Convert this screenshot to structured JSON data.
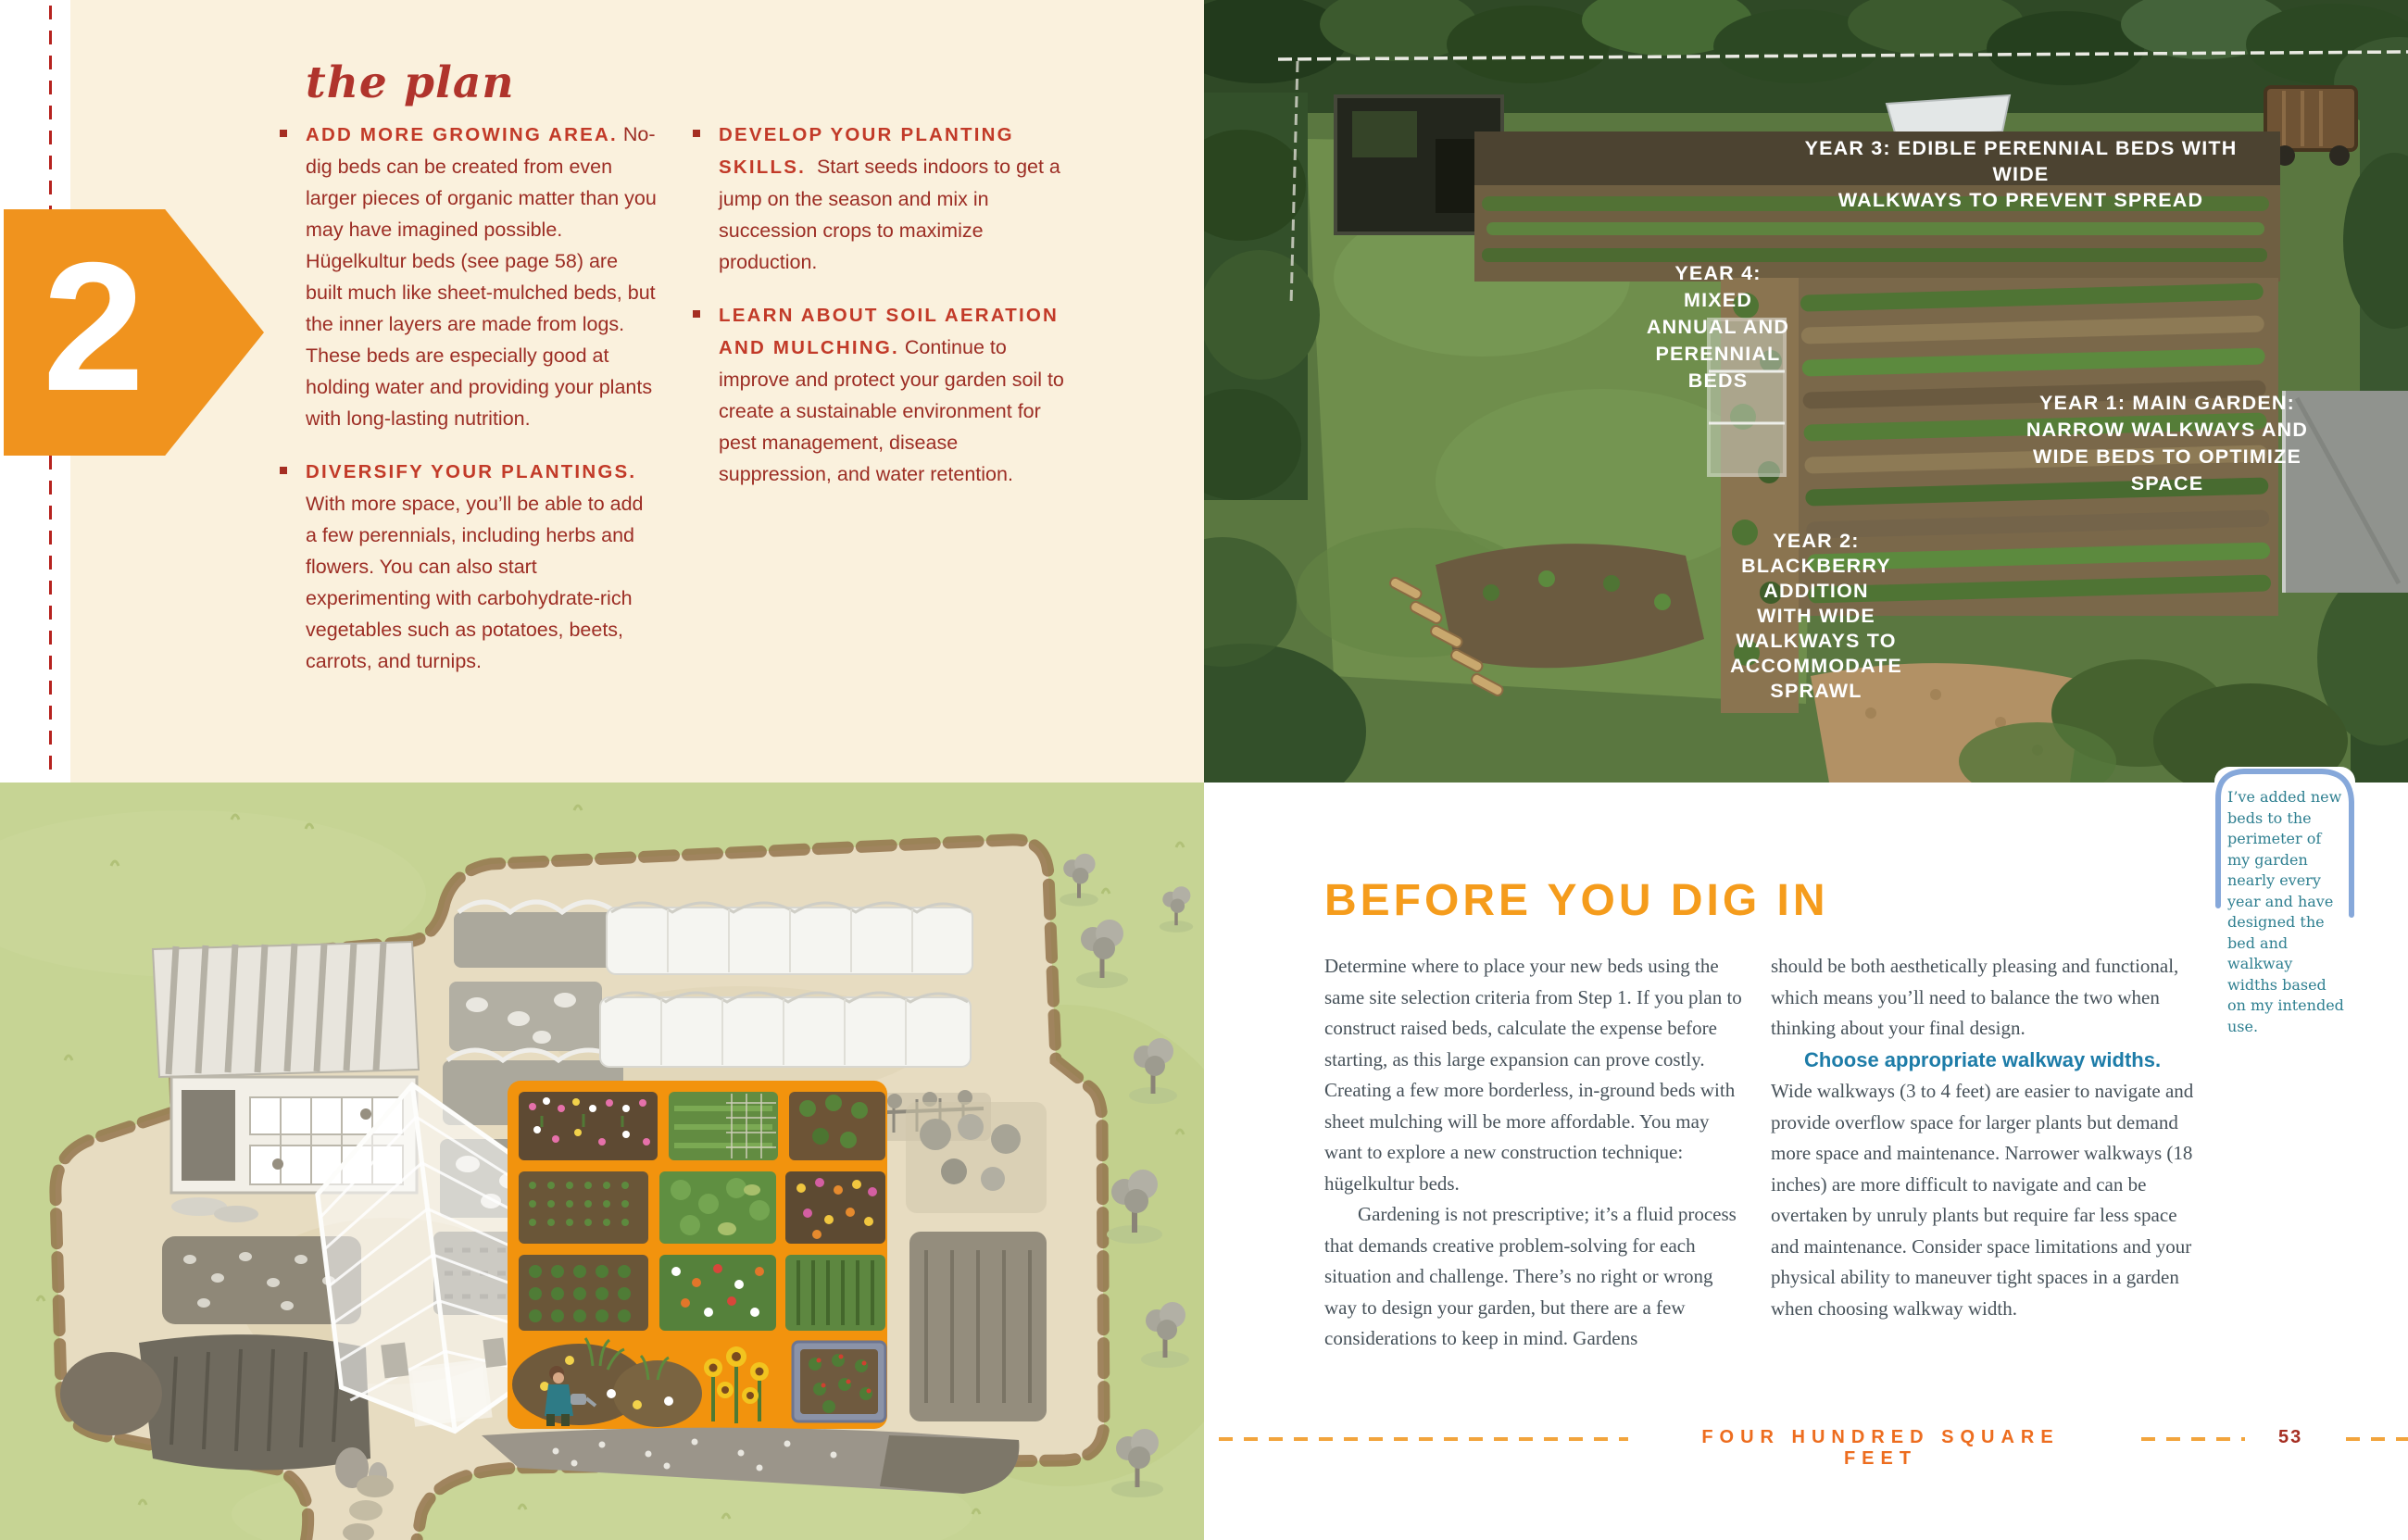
{
  "colors": {
    "cream_panel": "#faf1dd",
    "step_arrow_orange": "#f0931e",
    "plan_heading_red": "#b0342c",
    "bullet_head_red": "#c23a28",
    "bullet_body_red": "#9c2d24",
    "dashed_margin_red": "#b6231f",
    "article_heading_orange": "#f59c1c",
    "article_body_grey": "#47525a",
    "walkway_lead_blue": "#1d7ca8",
    "note_teal": "#2e7f90",
    "note_border_blue": "#86a8da",
    "footer_title_orange": "#ed6d1f",
    "footer_dash_orange": "#f2a43c",
    "page_number_red": "#a52e22",
    "illustration_grass_green": "#c6d494",
    "illustration_highlight_orange": "#f2930d"
  },
  "left_page": {
    "step_number": "2",
    "heading": "the plan",
    "columns": [
      {
        "items": [
          {
            "head": "ADD MORE GROWING AREA.",
            "body": "No-dig beds can be created from even larger pieces of organic matter than you may have imagined possible. Hügelkultur beds (see page 58) are built much like sheet-mulched beds, but the inner layers are made from logs. These beds are especially good at holding water and providing your plants with long-lasting nutrition."
          },
          {
            "head": "DIVERSIFY YOUR PLANTINGS.",
            "body": "With more space, you’ll be able to add a few perennials, including herbs and flowers. You can also start experimenting with carbohydrate-rich vegetables such as potatoes, beets, carrots, and turnips."
          }
        ]
      },
      {
        "items": [
          {
            "head": "DEVELOP YOUR PLANTING SKILLS.",
            "body": "Start seeds indoors to get a jump on the season and mix in succession crops to maximize production."
          },
          {
            "head": "LEARN ABOUT SOIL AERATION AND MULCHING.",
            "body": "Continue to improve and protect your garden soil to create a sustainable environment for pest management, disease suppression, and water retention."
          }
        ]
      }
    ]
  },
  "photo": {
    "labels": [
      {
        "name": "year-3",
        "lines": [
          "YEAR 3: EDIBLE PERENNIAL BEDS WITH WIDE",
          "WALKWAYS TO PREVENT SPREAD"
        ]
      },
      {
        "name": "year-4",
        "lines": [
          "YEAR 4:",
          "MIXED",
          "ANNUAL AND",
          "PERENNIAL",
          "BEDS"
        ]
      },
      {
        "name": "year-1",
        "lines": [
          "YEAR 1: MAIN GARDEN:",
          "NARROW WALKWAYS AND",
          "WIDE BEDS TO OPTIMIZE",
          "SPACE"
        ]
      },
      {
        "name": "year-2",
        "lines": [
          "YEAR 2:",
          "BLACKBERRY",
          "ADDITION",
          "WITH WIDE",
          "WALKWAYS TO",
          "ACCOMMODATE",
          "SPRAWL"
        ]
      }
    ]
  },
  "article": {
    "heading": "BEFORE YOU DIG IN",
    "col1": {
      "p1": "Determine where to place your new beds using the same site selection criteria from Step 1. If you plan to construct raised beds, calculate the expense before starting, as this large expansion can prove costly. Creating a few more borderless, in-ground beds with sheet mulching will be more affordable. You may want to explore a new construction technique: hügelkultur beds.",
      "p2": "Gardening is not prescriptive; it’s a fluid process that demands creative problem-solving for each situation and challenge. There’s no right or wrong way to design your garden, but there are a few considerations to keep in mind. Gardens"
    },
    "col2": {
      "p1": "should be both aesthetically pleasing and functional, which means you’ll need to balance the two when thinking about your final design.",
      "lead": "Choose appropriate walkway widths.",
      "p2": "Wide walkways (3 to 4 feet) are easier to navigate and provide overflow space for larger plants but demand more space and maintenance. Narrower walkways (18 inches) are more difficult to navigate and can be overtaken by unruly plants but require far less space and maintenance. Consider space limitations and your physical ability to maneuver tight spaces in a garden when choosing walkway width."
    }
  },
  "note": {
    "text": "I’ve added new beds to the perimeter of my garden nearly every year and have designed the bed and walkway widths based on my intended use."
  },
  "footer": {
    "label": "FOUR HUNDRED SQUARE FEET",
    "page_number": "53"
  }
}
